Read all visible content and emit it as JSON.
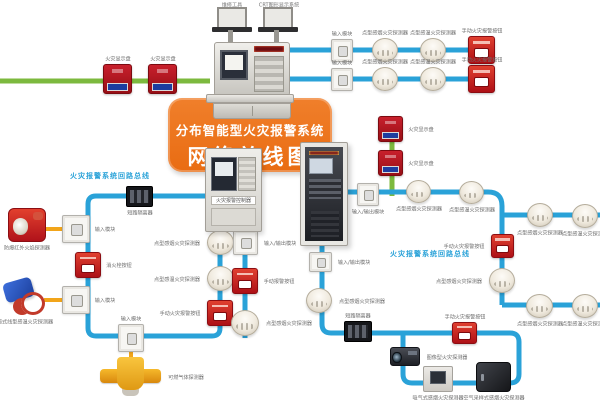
{
  "title": {
    "line1": "分布智能型火灾报警系统",
    "line2": "网络总线图"
  },
  "colors": {
    "blue": "#2aa2d8",
    "green": "#7cb93e",
    "orange": "#ee7322",
    "yellow": "#f2a51a",
    "red": "#c0161d"
  },
  "laptops": [
    {
      "label": "维修工具"
    },
    {
      "label": "CRT图形显示系统"
    }
  ],
  "panel": {
    "label": "火灾报警控制器"
  },
  "bus_labels": [
    {
      "text": "火灾报警系统回路总线",
      "x": 70,
      "y": 171
    },
    {
      "text": "火灾报警系统回路总线",
      "x": 390,
      "y": 249
    }
  ],
  "buses": [
    {
      "color": "green",
      "path": "M0,81 H210",
      "w": 5
    },
    {
      "color": "blue",
      "path": "M288,50 H482",
      "w": 5
    },
    {
      "color": "blue",
      "path": "M288,79 H482",
      "w": 5
    },
    {
      "color": "green",
      "path": "M392,118 V196",
      "w": 5
    },
    {
      "color": "blue",
      "path": "M206,196 H96 Q88,196 88,204 V328 Q88,336 96,336 H212 Q220,336 220,328 V232",
      "w": 5
    },
    {
      "color": "blue",
      "path": "M245,232 V338",
      "w": 5
    },
    {
      "color": "blue",
      "path": "M348,192 H488 Q502,192 502,206 V305",
      "w": 5
    },
    {
      "color": "blue",
      "path": "M502,215 H600",
      "w": 5
    },
    {
      "color": "blue",
      "path": "M502,305 H600",
      "w": 5
    },
    {
      "color": "blue",
      "path": "M322,246 V324 Q322,333 331,333 H510 Q519,333 519,342 V374 Q519,383 510,383 H412 Q403,383 403,374 V333",
      "w": 5
    },
    {
      "color": "yellow",
      "path": "M46,229 H64",
      "w": 4
    },
    {
      "color": "yellow",
      "path": "M44,300 H64",
      "w": 4
    },
    {
      "color": "yellow",
      "path": "M131,352 V360",
      "w": 4
    }
  ],
  "devices": [
    {
      "t": "display-panel",
      "x": 103,
      "y": 64,
      "w": 29,
      "h": 30,
      "label": "火灾显示盘",
      "pos": "top"
    },
    {
      "t": "display-panel",
      "x": 148,
      "y": 64,
      "w": 29,
      "h": 30,
      "label": "火灾显示盘",
      "pos": "top"
    },
    {
      "t": "module",
      "x": 331,
      "y": 39,
      "w": 22,
      "h": 23,
      "label": "输入模块",
      "pos": "top"
    },
    {
      "t": "detector",
      "x": 372,
      "y": 38,
      "w": 26,
      "h": 24,
      "label": "点型感烟火灾探测器",
      "pos": "top"
    },
    {
      "t": "detector",
      "x": 420,
      "y": 38,
      "w": 26,
      "h": 24,
      "label": "点型感温火灾探测器",
      "pos": "top"
    },
    {
      "t": "callpoint",
      "x": 468,
      "y": 36,
      "w": 27,
      "h": 28,
      "label": "手动火灾报警按钮",
      "pos": "top"
    },
    {
      "t": "module",
      "x": 331,
      "y": 68,
      "w": 22,
      "h": 23,
      "label": "输入模块",
      "pos": "top"
    },
    {
      "t": "detector",
      "x": 372,
      "y": 67,
      "w": 26,
      "h": 24,
      "label": "点型感烟火灾探测器",
      "pos": "top"
    },
    {
      "t": "detector",
      "x": 420,
      "y": 67,
      "w": 26,
      "h": 24,
      "label": "点型感温火灾探测器",
      "pos": "top"
    },
    {
      "t": "callpoint",
      "x": 468,
      "y": 65,
      "w": 27,
      "h": 28,
      "label": "手动火灾报警按钮",
      "pos": "top"
    },
    {
      "t": "display-panel",
      "x": 378,
      "y": 116,
      "w": 25,
      "h": 26,
      "label": "火灾显示盘",
      "pos": "right"
    },
    {
      "t": "display-panel",
      "x": 378,
      "y": 150,
      "w": 25,
      "h": 26,
      "label": "火灾显示盘",
      "pos": "right"
    },
    {
      "t": "flame-detector",
      "x": 8,
      "y": 208,
      "w": 38,
      "h": 34,
      "label": "防爆红外火焰探测器",
      "pos": "bottom"
    },
    {
      "t": "module",
      "x": 62,
      "y": 215,
      "w": 28,
      "h": 28,
      "label": "输入模块",
      "pos": "right"
    },
    {
      "t": "callpoint",
      "x": 75,
      "y": 252,
      "w": 26,
      "h": 26,
      "label": "消火栓按钮",
      "pos": "right"
    },
    {
      "t": "module",
      "x": 62,
      "y": 286,
      "w": 28,
      "h": 28,
      "label": "输入模块",
      "pos": "right"
    },
    {
      "t": "cable-detector",
      "x": 4,
      "y": 277,
      "w": 42,
      "h": 38,
      "label": "缆式线型感温火灾探测器",
      "pos": "bottom"
    },
    {
      "t": "isolator",
      "x": 126,
      "y": 186,
      "w": 27,
      "h": 21,
      "label": "短路隔离器",
      "pos": "bottom"
    },
    {
      "t": "module",
      "x": 118,
      "y": 324,
      "w": 26,
      "h": 28,
      "label": "输入模块",
      "pos": "top"
    },
    {
      "t": "gas-detector",
      "x": 100,
      "y": 357,
      "w": 61,
      "h": 40,
      "label": "可燃气体探测器",
      "pos": "right"
    },
    {
      "t": "detector",
      "x": 207,
      "y": 230,
      "w": 27,
      "h": 25,
      "label": "点型感烟火灾探测器",
      "pos": "left"
    },
    {
      "t": "detector",
      "x": 207,
      "y": 266,
      "w": 27,
      "h": 25,
      "label": "点型感温火灾探测器",
      "pos": "left"
    },
    {
      "t": "callpoint",
      "x": 207,
      "y": 300,
      "w": 26,
      "h": 26,
      "label": "手动火灾报警按钮",
      "pos": "left"
    },
    {
      "t": "module",
      "x": 233,
      "y": 230,
      "w": 25,
      "h": 25,
      "label": "输入/输出模块",
      "pos": "right"
    },
    {
      "t": "callpoint",
      "x": 232,
      "y": 268,
      "w": 26,
      "h": 26,
      "label": "手动报警按钮",
      "pos": "right"
    },
    {
      "t": "detector",
      "x": 231,
      "y": 310,
      "w": 28,
      "h": 26,
      "label": "点型感烟火灾探测器",
      "pos": "right"
    },
    {
      "t": "module",
      "x": 309,
      "y": 252,
      "w": 23,
      "h": 20,
      "label": "输入/输出模块",
      "pos": "right"
    },
    {
      "t": "detector",
      "x": 306,
      "y": 288,
      "w": 26,
      "h": 25,
      "label": "点型感烟火灾探测器",
      "pos": "right"
    },
    {
      "t": "isolator",
      "x": 344,
      "y": 321,
      "w": 28,
      "h": 21,
      "label": "短路隔离器",
      "pos": "top"
    },
    {
      "t": "callpoint",
      "x": 452,
      "y": 322,
      "w": 25,
      "h": 22,
      "label": "手动火灾报警按钮",
      "pos": "top"
    },
    {
      "t": "camera-detector",
      "x": 390,
      "y": 347,
      "w": 30,
      "h": 19,
      "label": "图像型火灾探测器",
      "pos": "right"
    },
    {
      "t": "aspirating-panel",
      "x": 423,
      "y": 366,
      "w": 30,
      "h": 26,
      "label": "吸气式感烟火灾探测器",
      "pos": "bottom"
    },
    {
      "t": "sampling-unit",
      "x": 476,
      "y": 362,
      "w": 35,
      "h": 30,
      "label": "空气采样式感烟火灾探测器",
      "pos": "bottom"
    },
    {
      "t": "module",
      "x": 357,
      "y": 183,
      "w": 22,
      "h": 23,
      "label": "输入/输出模块",
      "pos": "bottom"
    },
    {
      "t": "detector",
      "x": 406,
      "y": 180,
      "w": 25,
      "h": 23,
      "label": "点型感烟火灾探测器",
      "pos": "bottom"
    },
    {
      "t": "detector",
      "x": 459,
      "y": 181,
      "w": 25,
      "h": 23,
      "label": "点型感温火灾探测器",
      "pos": "bottom"
    },
    {
      "t": "detector",
      "x": 527,
      "y": 203,
      "w": 26,
      "h": 24,
      "label": "点型感烟火灾探测器",
      "pos": "bottom"
    },
    {
      "t": "detector",
      "x": 572,
      "y": 204,
      "w": 26,
      "h": 24,
      "label": "点型感温火灾探测器",
      "pos": "bottom"
    },
    {
      "t": "callpoint",
      "x": 491,
      "y": 234,
      "w": 23,
      "h": 24,
      "label": "手动火灾报警按钮",
      "pos": "left"
    },
    {
      "t": "detector",
      "x": 489,
      "y": 268,
      "w": 26,
      "h": 25,
      "label": "点型感烟火灾探测器",
      "pos": "left"
    },
    {
      "t": "detector",
      "x": 526,
      "y": 294,
      "w": 27,
      "h": 24,
      "label": "点型感烟火灾探测器",
      "pos": "bottom"
    },
    {
      "t": "detector",
      "x": 572,
      "y": 294,
      "w": 26,
      "h": 24,
      "label": "点型感温火灾探测器",
      "pos": "bottom"
    }
  ]
}
